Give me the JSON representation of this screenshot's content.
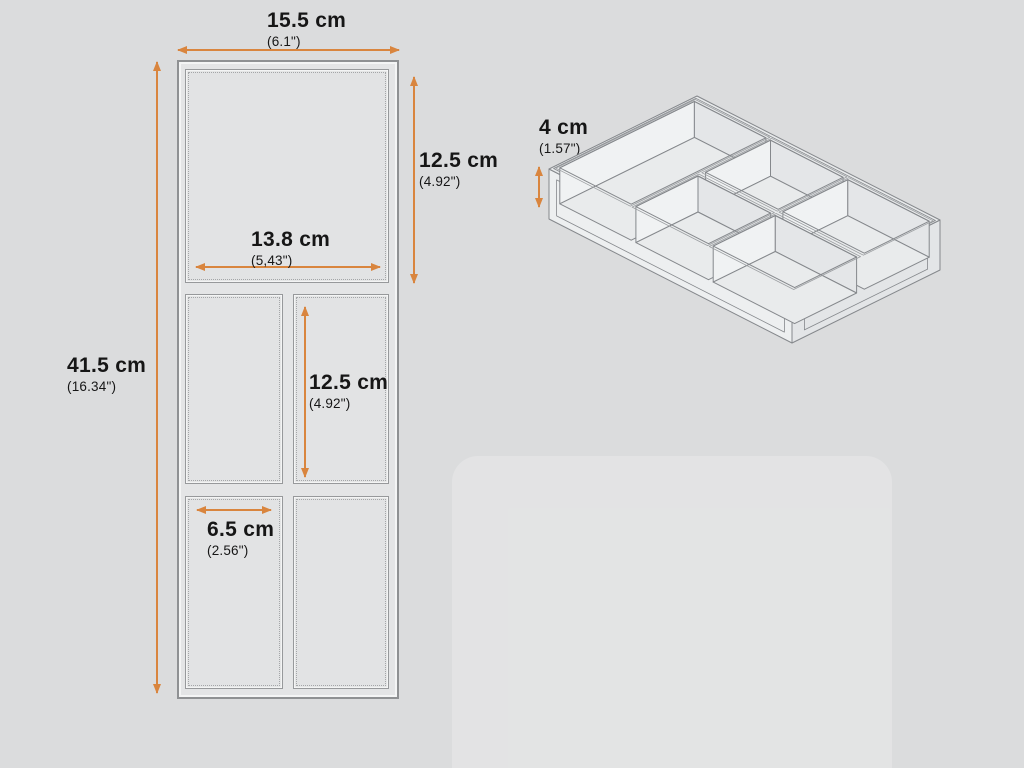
{
  "diagram": {
    "subject": "drawer-organizer-tray",
    "accent_color": "#d9853e",
    "background_color": "#dbdcdd",
    "line_color": "#85888c",
    "text_color": "#161616"
  },
  "flat_view": {
    "compartments": [
      "top-large",
      "middle-left",
      "middle-right",
      "bottom-left",
      "bottom-right"
    ],
    "dims": {
      "total_width": {
        "value": "15.5 cm",
        "alt": "(6.1\")"
      },
      "total_height": {
        "value": "41.5 cm",
        "alt": "(16.34\")"
      },
      "top_compartment_height": {
        "value": "12.5 cm",
        "alt": "(4.92\")"
      },
      "top_compartment_width": {
        "value": "13.8 cm",
        "alt": "(5,43\")"
      },
      "middle_compartment_height": {
        "value": "12.5 cm",
        "alt": "(4.92\")"
      },
      "bottom_compartment_width": {
        "value": "6.5 cm",
        "alt": "(2.56\")"
      }
    }
  },
  "iso_view": {
    "compartment_count": 5,
    "dims": {
      "tray_height": {
        "value": "4 cm",
        "alt": "(1.57\")"
      }
    }
  }
}
